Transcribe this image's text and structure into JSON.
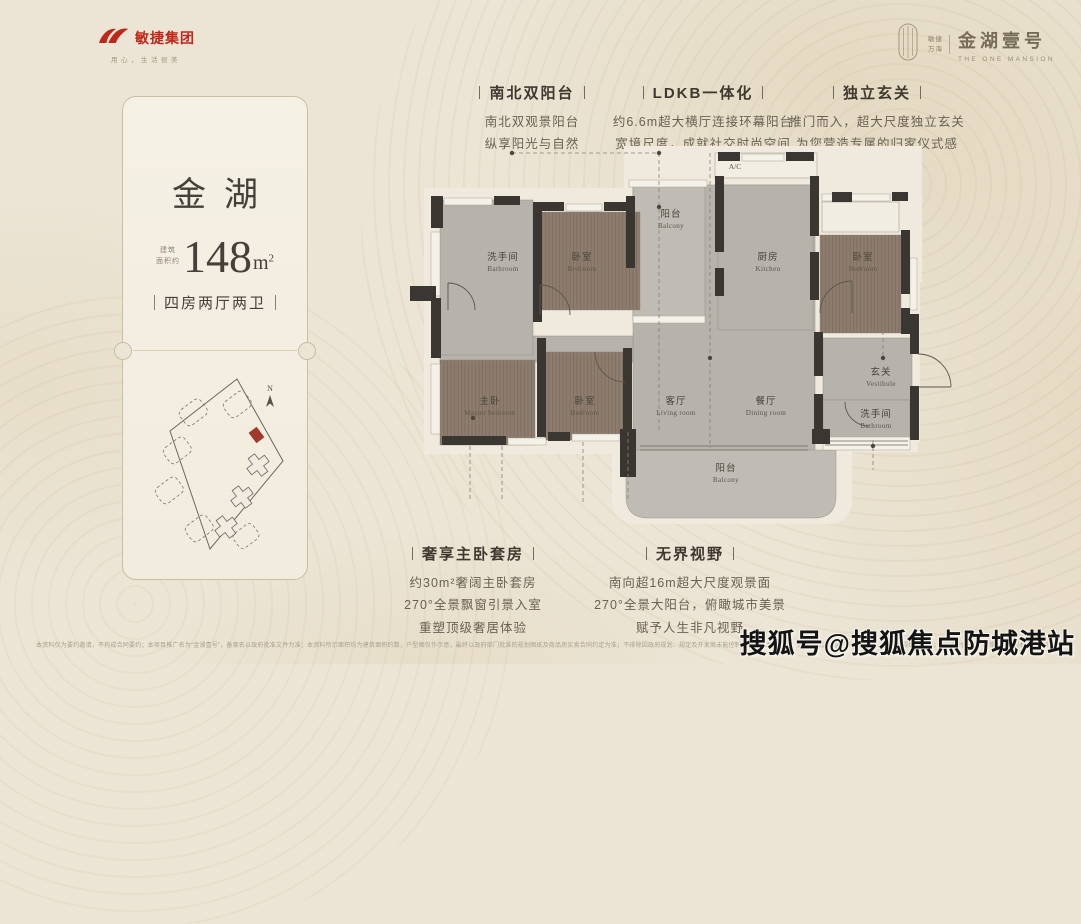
{
  "header": {
    "brand_left": {
      "name": "敏捷集团",
      "tagline": "用心，生活很美"
    },
    "brand_right": {
      "pre_line1": "敏捷",
      "pre_line2": "万海",
      "name": "金湖壹号",
      "sub": "THE ONE MANSION"
    }
  },
  "card": {
    "title": "金湖",
    "area_prefix_line1": "建筑",
    "area_prefix_line2": "面积约",
    "area_value": "148",
    "area_unit": "m",
    "area_sup": "2",
    "spec": "四房两厅两卫",
    "compass": "N"
  },
  "callouts_top": [
    {
      "title": "南北双阳台",
      "line1": "南北双观景阳台",
      "line2": "纵享阳光与自然"
    },
    {
      "title": "LDKB一体化",
      "line1": "约6.6m超大横厅连接环幕阳台",
      "line2": "宽境尺度，成就社交时尚空间"
    },
    {
      "title": "独立玄关",
      "line1": "推门而入，超大尺度独立玄关",
      "line2": "为您营造专属的归家仪式感"
    }
  ],
  "callouts_bottom": [
    {
      "title": "奢享主卧套房",
      "line1": "约30m²奢阔主卧套房",
      "line2": "270°全景飘窗引景入室",
      "line3": "重塑顶级奢居体验"
    },
    {
      "title": "无界视野",
      "line1": "南向超16m超大尺度观景面",
      "line2": "270°全景大阳台，俯瞰城市美景",
      "line3": "赋予人生非凡视野"
    }
  ],
  "floorplan": {
    "ac_label": "A/C",
    "rooms": [
      {
        "id": "bathroom-nw",
        "cn": "洗手间",
        "en": "Bathroom"
      },
      {
        "id": "bedroom-nw",
        "cn": "卧室",
        "en": "Bedroom"
      },
      {
        "id": "balcony-n",
        "cn": "阳台",
        "en": "Balcony"
      },
      {
        "id": "kitchen",
        "cn": "厨房",
        "en": "Kitchen"
      },
      {
        "id": "bedroom-ne",
        "cn": "卧室",
        "en": "Bedroom"
      },
      {
        "id": "master-bedroom",
        "cn": "主卧",
        "en": "Master bedroom"
      },
      {
        "id": "bedroom-s",
        "cn": "卧室",
        "en": "Bedroom"
      },
      {
        "id": "living-room",
        "cn": "客厅",
        "en": "Living room"
      },
      {
        "id": "dining-room",
        "cn": "餐厅",
        "en": "Dining room"
      },
      {
        "id": "vestibule",
        "cn": "玄关",
        "en": "Vestibule"
      },
      {
        "id": "bathroom-se",
        "cn": "洗手间",
        "en": "Bathroom"
      },
      {
        "id": "balcony-s",
        "cn": "阳台",
        "en": "Balcony"
      }
    ]
  },
  "footer": {
    "disclaimer": "本资料仅为要约邀请，不构成合同要约；本项目推广名为“金湖壹号”，备案名以政府批准文件为准；本资料所示面积均为建筑面积约数，户型图仅作示意，最终以政府部门批准的规划图纸及商品房买卖合同约定为准；不排除因政府规划、规定及开发商未能控制等原因而发生变化；交通及周边配套信息仅供参考，不作为要约或承诺；部分图片来源于网络，如有侵权请联系删除，详情请详询售楼部。",
    "watermark": "搜狐号@搜狐焦点防城港站"
  },
  "colors": {
    "background": "#ece5d6",
    "card_background": "#f4efe2",
    "accent_red": "#c0271b",
    "wall_dark": "#3a3732",
    "floor_gray": "#b6b3ad",
    "floor_wood": "#8e7d6e",
    "text_dark": "#3e382f",
    "text_muted": "#6a6054",
    "minimap_red": "#a03a2c"
  }
}
